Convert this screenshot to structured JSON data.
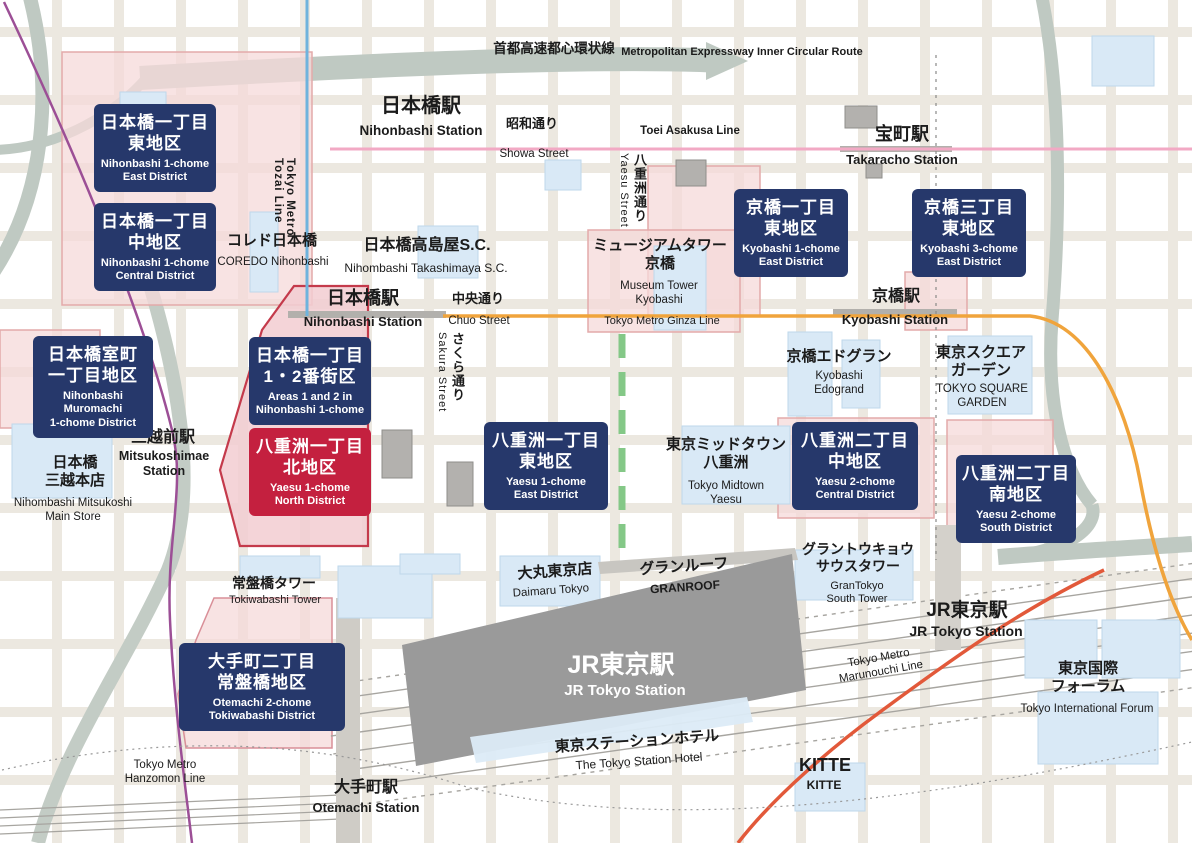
{
  "colors": {
    "district_navy": "#26386b",
    "district_red": "#c4203f",
    "district_area_pink": "#f5d9d9",
    "red_district_outline": "#c43a4b",
    "expressway_gray": "#bfc9c2",
    "ginza_line_orange": "#f0a43c",
    "asakusa_line_pink": "#f2a9c4",
    "marunouchi_line_red": "#e2593a",
    "hanzomon_line_purple": "#9c4f96",
    "tozai_line_blue": "#6fb3dd",
    "median_green": "#84c887",
    "building_blue": "#d9e9f6",
    "station_building_gray": "#9a9a9a"
  },
  "districts": [
    {
      "jp1": "日本橋一丁目",
      "jp2": "東地区",
      "en1": "Nihonbashi 1-chome",
      "en2": "East District",
      "style": "navy"
    },
    {
      "jp1": "日本橋一丁目",
      "jp2": "中地区",
      "en1": "Nihonbashi 1-chome",
      "en2": "Central District",
      "style": "navy"
    },
    {
      "jp1": "日本橋室町",
      "jp2": "一丁目地区",
      "en1": "Nihonbashi Muromachi",
      "en2": "1-chome District",
      "style": "navy"
    },
    {
      "jp1": "日本橋一丁目",
      "jp2": "1・2番街区",
      "en1": "Areas 1 and 2 in",
      "en2": "Nihonbashi 1-chome",
      "style": "navy"
    },
    {
      "jp1": "八重洲一丁目",
      "jp2": "北地区",
      "en1": "Yaesu 1-chome",
      "en2": "North District",
      "style": "red"
    },
    {
      "jp1": "八重洲一丁目",
      "jp2": "東地区",
      "en1": "Yaesu 1-chome",
      "en2": "East District",
      "style": "navy"
    },
    {
      "jp1": "京橋一丁目",
      "jp2": "東地区",
      "en1": "Kyobashi 1-chome",
      "en2": "East District",
      "style": "navy"
    },
    {
      "jp1": "京橋三丁目",
      "jp2": "東地区",
      "en1": "Kyobashi 3-chome",
      "en2": "East District",
      "style": "navy"
    },
    {
      "jp1": "八重洲二丁目",
      "jp2": "中地区",
      "en1": "Yaesu 2-chome",
      "en2": "Central District",
      "style": "navy"
    },
    {
      "jp1": "八重洲二丁目",
      "jp2": "南地区",
      "en1": "Yaesu 2-chome",
      "en2": "South District",
      "style": "navy"
    },
    {
      "jp1": "大手町二丁目",
      "jp2": "常盤橋地区",
      "en1": "Otemachi 2-chome",
      "en2": "Tokiwabashi District",
      "style": "navy"
    }
  ],
  "stations": {
    "nihonbashi_top": {
      "jp": "日本橋駅",
      "en": "Nihonbashi Station"
    },
    "takaracho": {
      "jp": "宝町駅",
      "en": "Takaracho Station"
    },
    "nihonbashi_chuo": {
      "jp": "日本橋駅",
      "en": "Nihonbashi Station"
    },
    "kyobashi": {
      "jp": "京橋駅",
      "en": "Kyobashi Station"
    },
    "mitsukoshimae": {
      "jp": "三越前駅",
      "en1": "Mitsukoshimae",
      "en2": "Station"
    },
    "otemachi": {
      "jp": "大手町駅",
      "en": "Otemachi Station"
    },
    "jr_tokyo_main": {
      "jp": "JR東京駅",
      "en": "JR Tokyo Station"
    },
    "jr_tokyo_east": {
      "jp": "JR東京駅",
      "en": "JR Tokyo Station"
    }
  },
  "places": {
    "coredo": {
      "jp": "コレド日本橋",
      "en": "COREDO Nihonbashi"
    },
    "takashimaya": {
      "jp": "日本橋高島屋S.C.",
      "en": "Nihombashi Takashimaya S.C."
    },
    "museum_tower": {
      "jp1": "ミュージアムタワー",
      "jp2": "京橋",
      "en1": "Museum Tower",
      "en2": "Kyobashi"
    },
    "edogran": {
      "jp": "京橋エドグラン",
      "en1": "Kyobashi",
      "en2": "Edogrand"
    },
    "square_garden": {
      "jp1": "東京スクエア",
      "jp2": "ガーデン",
      "en1": "TOKYO SQUARE",
      "en2": "GARDEN"
    },
    "mitsukoshi": {
      "jp1": "日本橋",
      "jp2": "三越本店",
      "en1": "Nihombashi Mitsukoshi",
      "en2": "Main Store"
    },
    "midtown": {
      "jp1": "東京ミッドタウン",
      "jp2": "八重洲",
      "en1": "Tokyo Midtown",
      "en2": "Yaesu"
    },
    "tokiwabashi_tower": {
      "jp": "常盤橋タワー",
      "en": "Tokiwabashi Tower"
    },
    "daimaru": {
      "jp": "大丸東京店",
      "en": "Daimaru Tokyo"
    },
    "granroof": {
      "jp": "グランルーフ",
      "en": "GRANROOF"
    },
    "gran_tokyo_south": {
      "jp1": "グラントウキョウ",
      "jp2": "サウスタワー",
      "en1": "GranTokyo",
      "en2": "South Tower"
    },
    "station_hotel": {
      "jp": "東京ステーションホテル",
      "en": "The Tokyo Station Hotel"
    },
    "kitte": {
      "jp": "KITTE",
      "en": "KITTE"
    },
    "intl_forum": {
      "jp1": "東京国際",
      "jp2": "フォーラム",
      "en": "Tokyo International Forum"
    }
  },
  "roads": {
    "expressway": {
      "jp": "首都高速都心環状線",
      "en": "Metropolitan Expressway Inner Circular Route"
    },
    "showa": {
      "jp": "昭和通り",
      "en": "Showa Street"
    },
    "chuo": {
      "jp": "中央通り",
      "en": "Chuo Street"
    },
    "yaesu": {
      "jp": "八重洲通り",
      "en": "Yaesu Street"
    },
    "sakura": {
      "jp": "さくら通り",
      "en": "Sakura Street"
    }
  },
  "rail_lines": {
    "asakusa": "Toei Asakusa Line",
    "ginza": "Tokyo Metro Ginza Line",
    "tozai1": "Tokyo Metro",
    "tozai2": "Tozai Line",
    "hanzomon1": "Tokyo Metro",
    "hanzomon2": "Hanzomon Line",
    "marunouchi1": "Tokyo Metro",
    "marunouchi2": "Marunouchi Line"
  }
}
